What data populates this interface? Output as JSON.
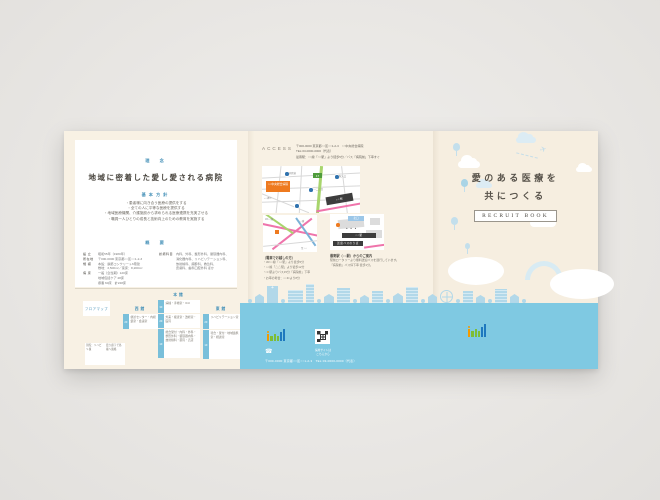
{
  "colors": {
    "backdrop": "#e9e7e4",
    "paper_cream": "#f8f1e4",
    "cover_cream": "#f6eee0",
    "accent_blue": "#4b94ba",
    "tab_blue": "#79bfda",
    "water_blue": "#7fc9e2",
    "skyline_blue": "#b2d8e9",
    "map_orange": "#ee7a1f",
    "map_green": "#a8d56d",
    "map_pink": "#ef74ab",
    "logo_orange": "#f39a00",
    "logo_green": "#7dbd36",
    "logo_blue": "#1e78be"
  },
  "left_panel": {
    "philosophy_label": "理　念",
    "title": "地域に密着した愛し愛される病院",
    "policy_label": "基本方針",
    "policy_items": [
      "・患者様に向き合う医療の提供をする",
      "・全ての人に平等な医療を提供する",
      "・地域医療機関、介護施設から求められる医療連携を充実させる",
      "・職員一人ひとりの成長と技術向上のための教育を実施する"
    ],
    "overview_label": "概　要",
    "overview_left": [
      {
        "label": "設 立",
        "value": "昭和55年（1980年）"
      },
      {
        "label": "所在地",
        "value": "〒000-0000 東京都○○区○○1-2-3"
      },
      {
        "label": "規 模",
        "value": "本館：鉄筋コンクリート6階建"
      },
      {
        "label": "",
        "value": "敷地：3,500m²／延床：8,200m²"
      },
      {
        "label": "病 床",
        "value": "一般（急性期）120床"
      },
      {
        "label": "",
        "value": "地域包括ケア 48床"
      },
      {
        "label": "",
        "value": "療養 60床　計228床"
      }
    ],
    "overview_right": [
      {
        "label": "診療科目",
        "value": "内科、外科、整形外科、循環器内科、"
      },
      {
        "label": "",
        "value": "消化器内科、リハビリテーション科、"
      },
      {
        "label": "",
        "value": "放射線科、麻酔科、救急科、"
      },
      {
        "label": "",
        "value": "皮膚科、歯科口腔外科 ほか"
      }
    ],
    "floor_map": {
      "title": "フロアマップ",
      "buildings": [
        {
          "name": "西館",
          "floors": [
            {
              "floor": "2F",
              "rooms": "健診センター・内視鏡室・会議室"
            }
          ]
        },
        {
          "name": "本館",
          "floors": [
            {
              "floor": "3F",
              "rooms": "病棟・手術室・ICU"
            },
            {
              "floor": "2F",
              "rooms": "外来・検査室・透析室・医局"
            },
            {
              "floor": "1F",
              "rooms": "総合受付・内科・外科・整形外科・循環器内科・放射線科・薬局・売店"
            }
          ]
        },
        {
          "name": "東館",
          "floors": [
            {
              "floor": "2F",
              "rooms": "リハビリテーション室"
            },
            {
              "floor": "1F",
              "rooms": "待合・受付・地域連携室・相談室"
            }
          ]
        }
      ],
      "notes": [
        "別館：リハビリ棟",
        "渡り廊下で各棟へ連絡"
      ]
    }
  },
  "middle_panel": {
    "access_label": "ACCESS",
    "access_lines": [
      "〒000-0000 東京都○○区○○1-2-3　○○中央総合病院",
      "TEL:03-0000-0000（代表）",
      "最寄駅：○○線「○○駅」より徒歩5分／バス「病院前」下車すぐ"
    ],
    "main_map": {
      "hospital_label": "○○中央総合病院",
      "station_label": "○○駅",
      "route_badge": "17",
      "street_label": "○○通り",
      "bus_stop_labels": [
        "病院前",
        "○○二丁目",
        "駅入口"
      ]
    },
    "area_map": {
      "caption": "〔電車でお越しの方〕",
      "line_labels": [
        "JR○○線",
        "○○線",
        "至 ○○"
      ],
      "items": [
        "・JR○○線「○○駅」より徒歩5分",
        "・○○線「△△駅」より徒歩12分",
        "・□□駅よりバス15分「病院前」下車",
        "・お車の場合：○○ICより8分"
      ]
    },
    "station_map": {
      "caption": "最寄駅（○○駅）からのご案内",
      "labels": {
        "north_exit": "北口",
        "station": "○○駅",
        "bus": "送迎バスのりば"
      },
      "lines": [
        "駅前ロータリーより無料送迎バスを運行しています。",
        "「病院前」バス停下車 徒歩1分。"
      ]
    }
  },
  "cover_panel": {
    "title_line1": "愛のある医療を",
    "title_line2": "共につくる",
    "badge_label": "RECRUIT BOOK"
  },
  "back_panel": {
    "qr_caption": [
      "採用サイトは",
      "こちらから"
    ],
    "phone_icon_glyph": "☎",
    "address_line": "〒000-0000 東京都○○区○○1-2-3　TEL:03-0000-0000（代表）"
  }
}
